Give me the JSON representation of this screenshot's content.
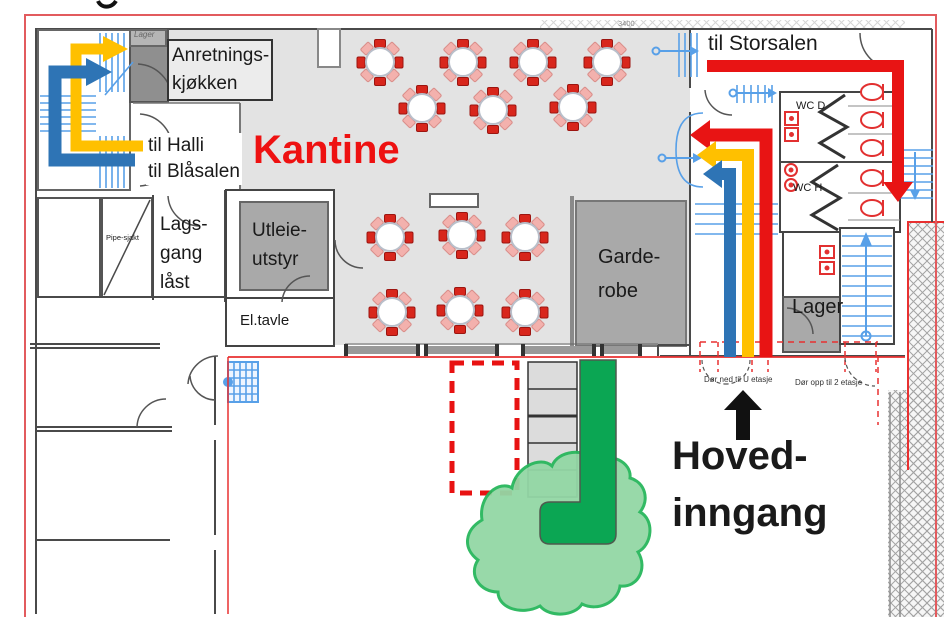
{
  "labels": {
    "kantine": "Kantine",
    "anretn_l1": "Anretnings-",
    "anretn_l2": "kjøkken",
    "til_halli": "til Halli",
    "til_blasalen": "til Blåsalen",
    "til_storsalen": "til Storsalen",
    "lager_small": "Lager",
    "lagsgang_l1": "Lags-",
    "lagsgang_l2": "gang",
    "lagsgang_l3": "låst",
    "pipesjakt": "Pipe-sjakt",
    "utleie_l1": "Utleie-",
    "utleie_l2": "utstyr",
    "eltavle": "El.tavle",
    "garderobe_l1": "Garde-",
    "garderobe_l2": "robe",
    "wc_d": "WC D",
    "wc_h": "WC H",
    "lager_right": "Lager",
    "dor_ned": "Dør ned til U etasje",
    "dor_opp": "Dør opp til 2 etasje",
    "hoved_l1": "Hoved-",
    "hoved_l2": "inngang",
    "dim_3400": "3400"
  },
  "colors": {
    "accent_red": "#ee1111",
    "route_red": "#e81414",
    "route_yellow": "#ffc000",
    "route_blue": "#2e74b5",
    "stair_blue": "#58a0e8",
    "fixture_red": "#e23030",
    "tree_green_fill": "#93d7a5",
    "tree_green_stroke": "#28b75c",
    "entrance_green": "#0ba653",
    "room_gray": "#a9a9a9",
    "floor_gray": "#e3e3e3"
  },
  "furniture": {
    "tables": [
      [
        380,
        62
      ],
      [
        463,
        62
      ],
      [
        533,
        62
      ],
      [
        607,
        62
      ],
      [
        422,
        108
      ],
      [
        493,
        110
      ],
      [
        573,
        107
      ],
      [
        390,
        237
      ],
      [
        462,
        235
      ],
      [
        525,
        237
      ],
      [
        392,
        312
      ],
      [
        460,
        310
      ],
      [
        525,
        312
      ]
    ],
    "chair_solid": "#d8261c",
    "chair_pale": "#f3b1ad",
    "toilets_y": [
      92,
      120,
      148,
      178,
      208
    ]
  },
  "routes": [
    {
      "name": "route-to-halli-blasalen-yellow",
      "color": "#ffc000"
    },
    {
      "name": "route-to-halli-blasalen-blue",
      "color": "#2e74b5"
    },
    {
      "name": "route-to-storsalen-red",
      "color": "#e81414"
    },
    {
      "name": "route-from-entrance-red",
      "color": "#e81414"
    },
    {
      "name": "route-from-entrance-yellow",
      "color": "#ffc000"
    },
    {
      "name": "route-from-entrance-blue",
      "color": "#2e74b5"
    }
  ]
}
